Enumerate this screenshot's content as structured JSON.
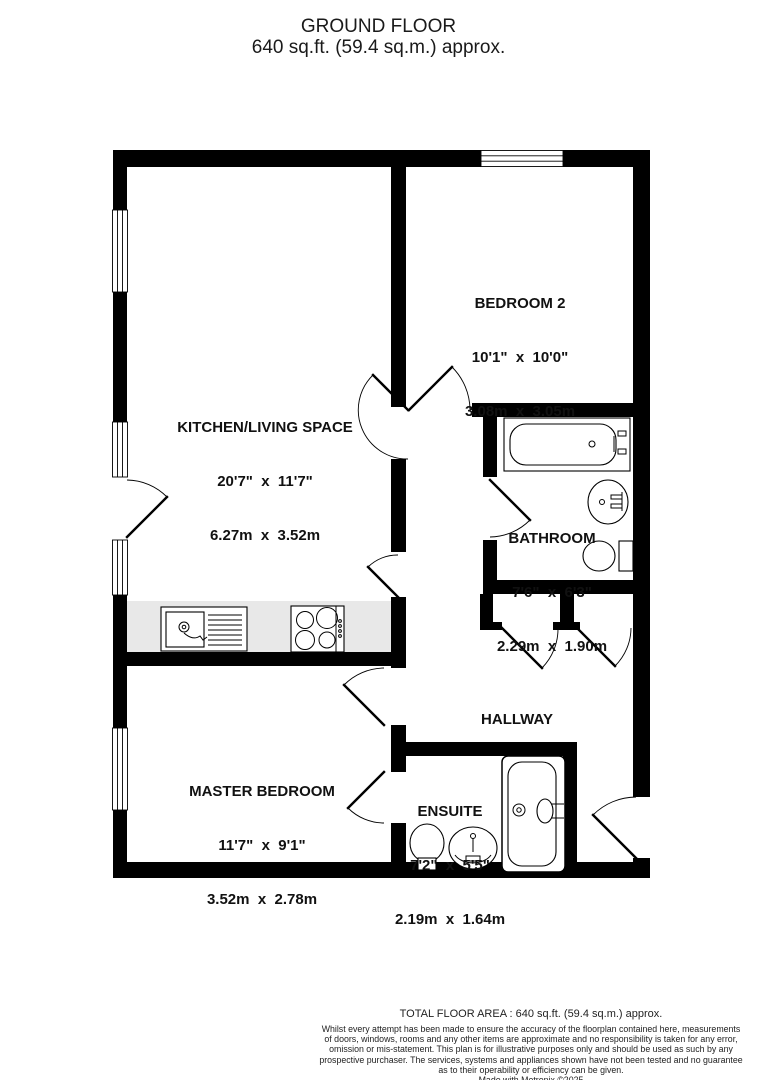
{
  "title": {
    "line1": "GROUND FLOOR",
    "line2": "640 sq.ft. (59.4 sq.m.) approx."
  },
  "rooms": {
    "bedroom2": {
      "name": "BEDROOM 2",
      "imperial": "10'1\"  x  10'0\"",
      "metric": "3.08m  x  3.05m"
    },
    "kitchen": {
      "name": "KITCHEN/LIVING SPACE",
      "imperial": "20'7\"  x  11'7\"",
      "metric": "6.27m  x  3.52m"
    },
    "bathroom": {
      "name": "BATHROOM",
      "imperial": "7'6\"  x  6'3\"",
      "metric": "2.29m  x  1.90m"
    },
    "hallway": {
      "name": "HALLWAY"
    },
    "master": {
      "name": "MASTER BEDROOM",
      "imperial": "11'7\"  x  9'1\"",
      "metric": "3.52m  x  2.78m"
    },
    "ensuite": {
      "name": "ENSUITE",
      "imperial": "7'2\"  x  5'5\"",
      "metric": "2.19m  x  1.64m"
    }
  },
  "footer": {
    "total": "TOTAL FLOOR AREA : 640 sq.ft. (59.4 sq.m.) approx.",
    "disclaimer_lines": [
      "Whilst every attempt has been made to ensure the accuracy of the floorplan contained here, measurements",
      "of doors, windows, rooms and any other items are approximate and no responsibility is taken for any error,",
      "omission or mis-statement. This plan is for illustrative purposes only and should be used as such by any",
      "prospective purchaser. The services, systems and appliances shown have not been tested and no guarantee",
      "as to their operability or efficiency can be given."
    ],
    "credit": "Made with Metropix ©2025"
  },
  "colors": {
    "wall": "#000000",
    "counter": "#e8e8e8",
    "background": "#ffffff"
  }
}
